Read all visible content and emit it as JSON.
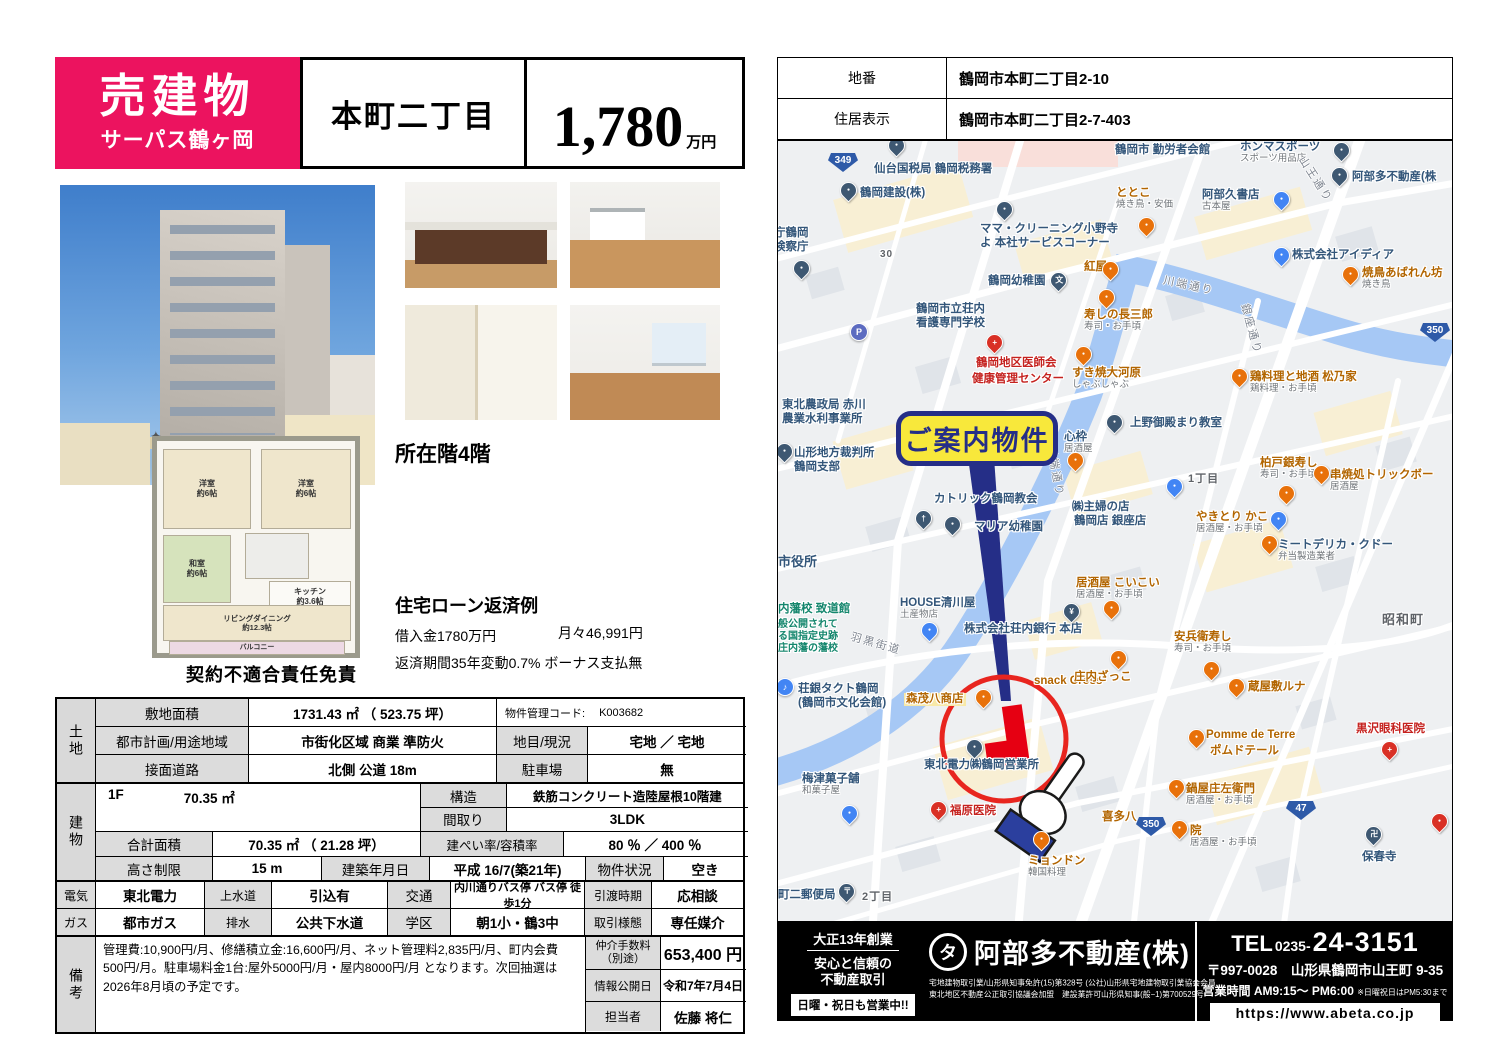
{
  "header": {
    "sale_type": "売建物",
    "building_name": "サーパス鶴ヶ岡",
    "location_title": "本町二丁目",
    "price": "1,780",
    "price_unit": "万円"
  },
  "info": {
    "floor": "所在階4階",
    "loan_title": "住宅ローン返済例",
    "loan_amount": "借入金1780万円",
    "loan_monthly": "月々46,991円",
    "loan_terms": "返済期間35年変動0.7% ボーナス支払無"
  },
  "floorplan": {
    "bed1": "洋室\n約6帖",
    "bed2": "洋室\n約6帖",
    "washitsu": "和室\n約6帖",
    "kitchen": "キッチン\n約3.6帖",
    "ld": "リビングダイニング\n約12.3帖",
    "balcony": "バルコニー",
    "disclaimer": "契約不適合責任免責",
    "compass": "✦"
  },
  "land": {
    "side": "土地",
    "r1c1": "敷地面積",
    "r1c2": "1731.43 ㎡ （ 523.75 坪）",
    "code_label": "物件管理コード:",
    "code_value": "K003682",
    "r2c1": "都市計画/用途地域",
    "r2c2": "市街化区域 商業 準防火",
    "r2c3": "地目/現況",
    "r2c4": "宅地 ／ 宅地",
    "r3c1": "接面道路",
    "r3c2": "北側 公道 18m",
    "r3c3": "駐車場",
    "r3c4": "無"
  },
  "building": {
    "side": "建物",
    "floor1_label": "1F",
    "floor1_area": "70.35 ㎡",
    "r1c2": "構造",
    "r1c3": "鉄筋コンクリート造陸屋根10階建",
    "r2c2": "間取り",
    "r2c3": "3LDK",
    "r3c1": "合計面積",
    "r3c2": "70.35 ㎡ （ 21.28 坪）",
    "r3c3": "建ぺい率/容積率",
    "r3c4": "80 ％ ／ 400 ％",
    "r4c1": "高さ制限",
    "r4c2": "15 m",
    "r4c3": "建築年月日",
    "r4c4": "平成 16/7(築21年)",
    "r4c5": "物件状況",
    "r4c6": "空き"
  },
  "utilities": {
    "r1": [
      "電気",
      "東北電力",
      "上水道",
      "引込有",
      "交通",
      "内川通りバス停 バス停 徒歩1分",
      "引渡時期",
      "応相談"
    ],
    "r2": [
      "ガス",
      "都市ガス",
      "排水",
      "公共下水道",
      "学区",
      "朝1小・鶴3中",
      "取引様態",
      "専任媒介"
    ]
  },
  "remarks": {
    "side": "備考",
    "text": "管理費:10,900円/月、修繕積立金:16,600円/月、ネット管理料2,835円/月、町内会費500円/月。駐車場料金1台:屋外5000円/月・屋内8000円/月 となります。次回抽選は2026年8月頃の予定です。",
    "fee_label": "仲介手数料\n（別途）",
    "fee_value": "653,400 円",
    "date_label": "情報公開日",
    "date_value": "令和7年7月4日",
    "agent_label": "担当者",
    "agent_value": "佐藤 将仁"
  },
  "address": {
    "banchi_label": "地番",
    "banchi": "鶴岡市本町二丁目2-10",
    "jukyo_label": "住居表示",
    "jukyo": "鶴岡市本町二丁目2-7-403"
  },
  "map": {
    "callout": "ご案内物件",
    "labels": [
      {
        "t": "鶴岡市 勤労者会館",
        "x": 337,
        "y": 3,
        "c": "poi"
      },
      {
        "t": "ホンマスポーツ",
        "s": "スポーツ用品店",
        "x": 462,
        "y": 0,
        "c": "poi"
      },
      {
        "t": "阿部多不動産(株",
        "x": 574,
        "y": 30,
        "c": "poi"
      },
      {
        "t": "仙台国税局 鶴岡税務署",
        "x": 96,
        "y": 22,
        "c": "poi"
      },
      {
        "t": "鶴岡建設(株)",
        "x": 82,
        "y": 46,
        "c": "poi"
      },
      {
        "t": "ととこ",
        "s": "焼き鳥・安価",
        "x": 338,
        "y": 46,
        "c": "food"
      },
      {
        "t": "阿部久書店",
        "s": "古本屋",
        "x": 424,
        "y": 48,
        "c": "poi"
      },
      {
        "t": "ママ・クリーニング小野寺",
        "x": 202,
        "y": 82,
        "c": "poi"
      },
      {
        "t": "よ 本社サービスコーナー",
        "x": 202,
        "y": 96,
        "c": "poi"
      },
      {
        "t": "庁鶴岡",
        "x": -4,
        "y": 86,
        "c": "poi"
      },
      {
        "t": "検察庁",
        "x": -4,
        "y": 100,
        "c": "poi"
      },
      {
        "t": "鶴岡幼稚園",
        "x": 210,
        "y": 134,
        "c": "poi"
      },
      {
        "t": "紅屋",
        "x": 306,
        "y": 120,
        "c": "food"
      },
      {
        "t": "株式会社アイディア",
        "x": 514,
        "y": 108,
        "c": "poi"
      },
      {
        "t": "焼鳥あばれん坊",
        "s": "焼き鳥",
        "x": 584,
        "y": 126,
        "c": "food"
      },
      {
        "t": "寿しの長三郎",
        "s": "寿司・お手頃",
        "x": 306,
        "y": 168,
        "c": "food"
      },
      {
        "t": "鶴岡市立荘内",
        "x": 138,
        "y": 162,
        "c": "poi"
      },
      {
        "t": "看護専門学校",
        "x": 138,
        "y": 176,
        "c": "poi"
      },
      {
        "t": "鶴岡地区医師会",
        "x": 198,
        "y": 216,
        "c": "red"
      },
      {
        "t": "健康管理センター",
        "x": 194,
        "y": 232,
        "c": "red"
      },
      {
        "t": "すき焼大河原",
        "s": "しゃぶしゃぶ",
        "x": 294,
        "y": 226,
        "c": "food"
      },
      {
        "t": "鶏料理と地酒 松乃家",
        "s": "鶏料理・お手頃",
        "x": 472,
        "y": 230,
        "c": "food"
      },
      {
        "t": "東北農政局 赤川",
        "x": 4,
        "y": 258,
        "c": "poi"
      },
      {
        "t": "農業水利事業所",
        "x": 4,
        "y": 272,
        "c": "poi"
      },
      {
        "t": "山形地方裁判所",
        "x": 16,
        "y": 306,
        "c": "poi"
      },
      {
        "t": "鶴岡支部",
        "x": 16,
        "y": 320,
        "c": "poi"
      },
      {
        "t": "心枠",
        "s": "居酒屋",
        "x": 286,
        "y": 290,
        "c": "poi"
      },
      {
        "t": "上野御殿まり教室",
        "x": 352,
        "y": 276,
        "c": "poi"
      },
      {
        "t": "柏戸銀寿し",
        "s": "寿司・お手頃",
        "x": 482,
        "y": 316,
        "c": "food"
      },
      {
        "t": "串焼処トリックボー",
        "s": "居酒屋",
        "x": 552,
        "y": 328,
        "c": "food"
      },
      {
        "t": "1丁目",
        "x": 410,
        "y": 332,
        "c": "area",
        "fs": 11
      },
      {
        "t": "カトリック鶴岡教会",
        "x": 156,
        "y": 352,
        "c": "poi"
      },
      {
        "t": "マリア幼稚園",
        "x": 196,
        "y": 380,
        "c": "poi"
      },
      {
        "t": "やきとり かこ",
        "s": "居酒屋・お手頃",
        "x": 418,
        "y": 370,
        "c": "food"
      },
      {
        "t": "ミートデリカ・クドー",
        "s": "弁当製造業者",
        "x": 500,
        "y": 398,
        "c": "poi"
      },
      {
        "t": "㈱主婦の店",
        "x": 294,
        "y": 360,
        "c": "poi"
      },
      {
        "t": "鶴岡店 銀座店",
        "x": 296,
        "y": 374,
        "c": "poi"
      },
      {
        "t": "居酒屋 こいこい",
        "s": "居酒屋・お手頃",
        "x": 298,
        "y": 436,
        "c": "food"
      },
      {
        "t": "HOUSE清川屋",
        "s": "土産物店",
        "x": 122,
        "y": 456,
        "c": "poi"
      },
      {
        "t": "株式会社荘内銀行 本店",
        "x": 186,
        "y": 482,
        "c": "poi"
      },
      {
        "t": "snack Cross",
        "x": 256,
        "y": 534,
        "c": "food"
      },
      {
        "t": "庄内ざっこ",
        "x": 296,
        "y": 530,
        "c": "food"
      },
      {
        "t": "安兵衛寿し",
        "s": "寿司・お手頃",
        "x": 396,
        "y": 490,
        "c": "food"
      },
      {
        "t": "蔵屋敷ルナ",
        "x": 470,
        "y": 540,
        "c": "food"
      },
      {
        "t": "市役所",
        "x": 0,
        "y": 414,
        "c": "poi",
        "fs": 13
      },
      {
        "t": "内藩校 致道館",
        "x": 0,
        "y": 462,
        "c": "teal"
      },
      {
        "t": "般公開されて",
        "x": 0,
        "y": 478,
        "c": "teal",
        "fs": 10
      },
      {
        "t": "る国指定史跡",
        "x": 0,
        "y": 490,
        "c": "teal",
        "fs": 10
      },
      {
        "t": "庄内藩の藩校",
        "x": 0,
        "y": 502,
        "c": "teal",
        "fs": 10
      },
      {
        "t": "荘銀タクト鶴岡",
        "x": 20,
        "y": 542,
        "c": "poi"
      },
      {
        "t": "(鶴岡市文化会館)",
        "x": 20,
        "y": 556,
        "c": "poi"
      },
      {
        "t": "森茂八商店",
        "x": 126,
        "y": 552,
        "c": "food",
        "bg": 1
      },
      {
        "t": "東北電力㈱鶴岡営業所",
        "x": 146,
        "y": 618,
        "c": "poi"
      },
      {
        "t": "梅津菓子舗",
        "s": "和菓子屋",
        "x": 24,
        "y": 632,
        "c": "poi"
      },
      {
        "t": "福原医院",
        "x": 172,
        "y": 664,
        "c": "red"
      },
      {
        "t": "ミョンドン",
        "s": "韓国料理",
        "x": 250,
        "y": 714,
        "c": "food"
      },
      {
        "t": "町二郵便局",
        "x": 0,
        "y": 748,
        "c": "poi"
      },
      {
        "t": "2丁目",
        "x": 84,
        "y": 750,
        "c": "area",
        "fs": 11
      },
      {
        "t": "喜多八",
        "x": 324,
        "y": 670,
        "c": "food"
      },
      {
        "t": "鍋屋庄左衛門",
        "s": "居酒屋・お手頃",
        "x": 408,
        "y": 642,
        "c": "food"
      },
      {
        "t": "院",
        "s": "居酒屋・お手頃",
        "x": 412,
        "y": 684,
        "c": "food"
      },
      {
        "t": "Pomme de Terre",
        "x": 428,
        "y": 588,
        "c": "food"
      },
      {
        "t": "ポムドテール",
        "x": 432,
        "y": 604,
        "c": "food"
      },
      {
        "t": "黒沢眼科医院",
        "x": 578,
        "y": 582,
        "c": "red"
      },
      {
        "t": "保春寺",
        "x": 584,
        "y": 710,
        "c": "poi"
      },
      {
        "t": "昭和町",
        "x": 604,
        "y": 472,
        "c": "area",
        "fs": 13
      },
      {
        "t": "30",
        "x": 102,
        "y": 108,
        "c": "area",
        "fs": 10
      }
    ],
    "road_labels": [
      {
        "t": "山王通り",
        "x": 512,
        "y": 30,
        "r": 57
      },
      {
        "t": "川端通り",
        "x": 385,
        "y": 136,
        "r": 12
      },
      {
        "t": "川端通り",
        "x": 252,
        "y": 322,
        "r": 80
      },
      {
        "t": "銀座通り",
        "x": 448,
        "y": 180,
        "r": 75
      },
      {
        "t": "羽黒街道",
        "x": 72,
        "y": 494,
        "r": 16
      }
    ],
    "pins": [
      {
        "x": 118,
        "y": 10,
        "k": "poi"
      },
      {
        "x": 70,
        "y": 55,
        "k": "poi"
      },
      {
        "x": 226,
        "y": 74,
        "k": "poi"
      },
      {
        "x": 23,
        "y": 133,
        "k": "poi"
      },
      {
        "x": 80,
        "y": 196,
        "k": "park",
        "g": "P"
      },
      {
        "x": 563,
        "y": 15,
        "k": "poi"
      },
      {
        "x": 561,
        "y": 40,
        "k": "poi"
      },
      {
        "x": 503,
        "y": 64,
        "k": "shop"
      },
      {
        "x": 368,
        "y": 90,
        "k": "food"
      },
      {
        "x": 332,
        "y": 134,
        "k": "food"
      },
      {
        "x": 280,
        "y": 145,
        "k": "poi",
        "g": "文"
      },
      {
        "x": 503,
        "y": 120,
        "k": "shop"
      },
      {
        "x": 572,
        "y": 139,
        "k": "food"
      },
      {
        "x": 328,
        "y": 162,
        "k": "food"
      },
      {
        "x": 216,
        "y": 207,
        "k": "red",
        "g": "+"
      },
      {
        "x": 305,
        "y": 219,
        "k": "food"
      },
      {
        "x": 461,
        "y": 241,
        "k": "food"
      },
      {
        "x": 6,
        "y": 316,
        "k": "poi"
      },
      {
        "x": 297,
        "y": 325,
        "k": "food"
      },
      {
        "x": 336,
        "y": 287,
        "k": "poi"
      },
      {
        "x": 508,
        "y": 358,
        "k": "food"
      },
      {
        "x": 543,
        "y": 338,
        "k": "food"
      },
      {
        "x": 145,
        "y": 383,
        "k": "poi",
        "g": "†"
      },
      {
        "x": 174,
        "y": 389,
        "k": "poi"
      },
      {
        "x": 500,
        "y": 384,
        "k": "shop"
      },
      {
        "x": 491,
        "y": 408,
        "k": "food"
      },
      {
        "x": 396,
        "y": 351,
        "k": "shop"
      },
      {
        "x": 151,
        "y": 495,
        "k": "shop"
      },
      {
        "x": 293,
        "y": 476,
        "k": "poi",
        "g": "¥"
      },
      {
        "x": 340,
        "y": 523,
        "k": "food"
      },
      {
        "x": 333,
        "y": 473,
        "k": "food"
      },
      {
        "x": 433,
        "y": 534,
        "k": "food"
      },
      {
        "x": 458,
        "y": 551,
        "k": "food"
      },
      {
        "x": 6,
        "y": 551,
        "k": "music",
        "g": "♪"
      },
      {
        "x": 205,
        "y": 562,
        "k": "food"
      },
      {
        "x": 196,
        "y": 612,
        "k": "poi"
      },
      {
        "x": 71,
        "y": 678,
        "k": "shop"
      },
      {
        "x": 160,
        "y": 674,
        "k": "red",
        "g": "+"
      },
      {
        "x": 263,
        "y": 704,
        "k": "food"
      },
      {
        "x": 68,
        "y": 756,
        "k": "poi",
        "g": "〒"
      },
      {
        "x": 398,
        "y": 652,
        "k": "food"
      },
      {
        "x": 401,
        "y": 693,
        "k": "food"
      },
      {
        "x": 418,
        "y": 602,
        "k": "food"
      },
      {
        "x": 611,
        "y": 614,
        "k": "red",
        "g": "+"
      },
      {
        "x": 595,
        "y": 699,
        "k": "poi",
        "g": "卍"
      },
      {
        "x": 661,
        "y": 686,
        "k": "red"
      }
    ],
    "badges": [
      {
        "n": "349",
        "x": 50,
        "y": 12
      },
      {
        "n": "350",
        "x": 642,
        "y": 182
      },
      {
        "n": "350",
        "x": 358,
        "y": 676
      },
      {
        "n": "47",
        "x": 508,
        "y": 660
      }
    ]
  },
  "footer": {
    "est": "大正13年創業",
    "slogan1": "安心と信頼の",
    "slogan2": "不動産取引",
    "open": "日曜・祝日も営業中!!",
    "logo_char": "タ",
    "company": "阿部多不動産(株)",
    "license1": "宅地建物取引業/山形県知事免許(15)第328号 (公社)山形県宅地建物取引業協会会員",
    "license2": "東北地区不動産公正取引協議会加盟　建設業許可山形県知事(般−1)第700529号",
    "tel_label": "TEL",
    "tel_area": "0235-",
    "tel_num": "24-3151",
    "addr": "〒997-0028　山形県鶴岡市山王町 9-35",
    "hours": "営業時間 AM9:15〜 PM6:00",
    "hours_note": "※日曜祝日はPM5:30まで",
    "url": "https://www.abeta.co.jp"
  }
}
